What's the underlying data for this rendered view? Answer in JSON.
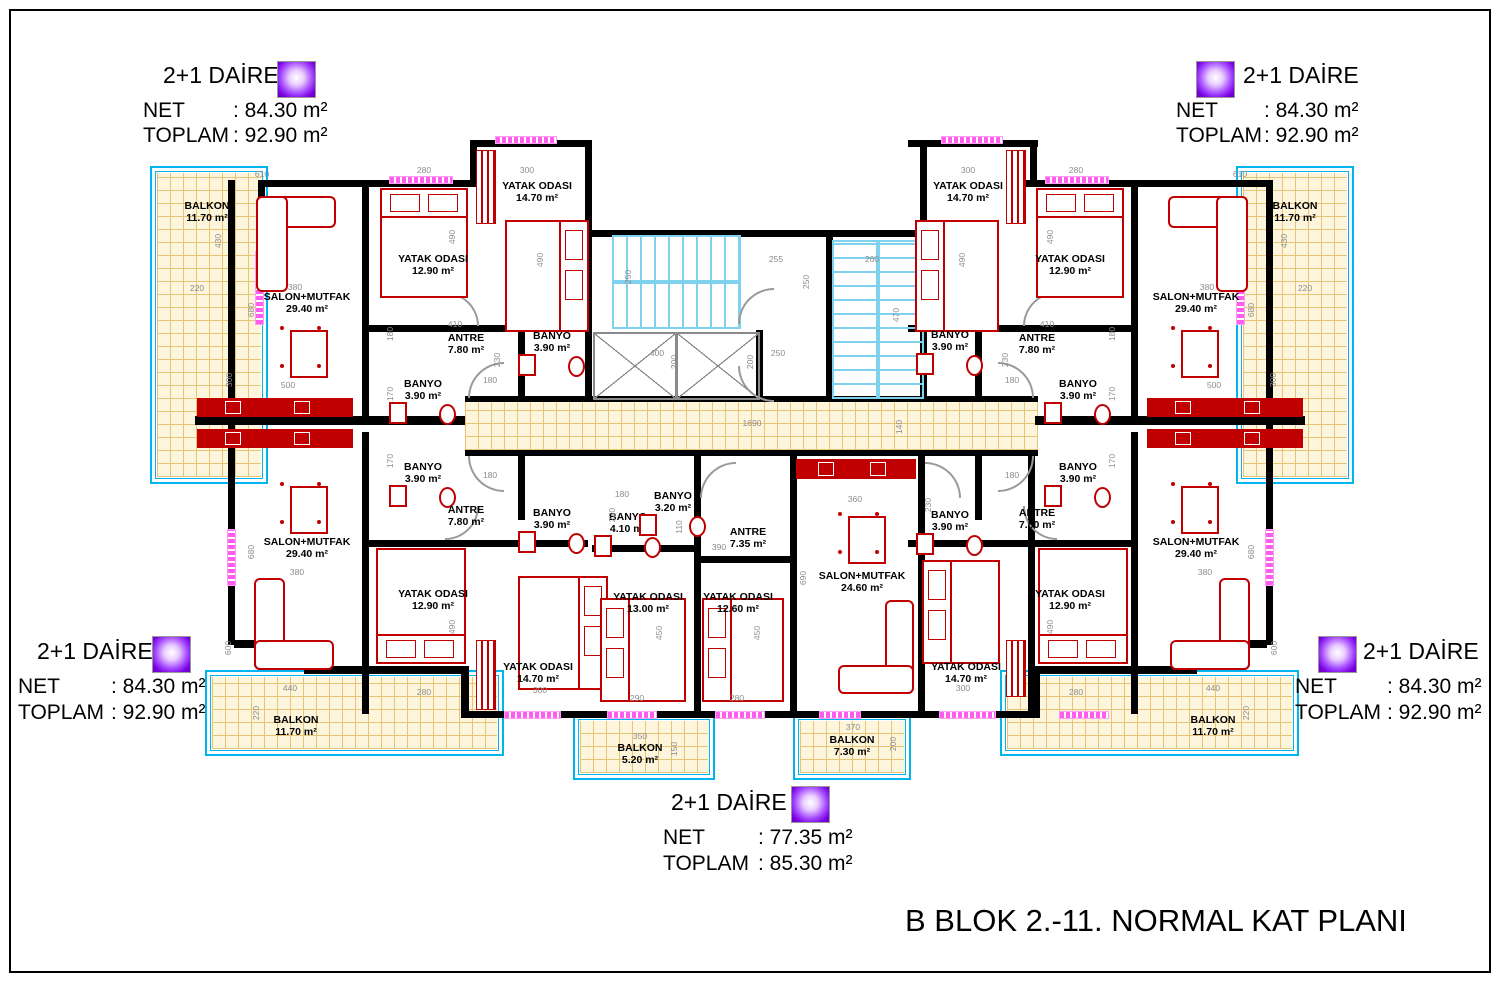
{
  "title": "B BLOK 2.-11. NORMAL KAT PLANI",
  "colors": {
    "wall": "#000000",
    "furniture": "#c00000",
    "stairs": "#7fd2ee",
    "balcony_border": "#00b4f0",
    "tile_line": "#e8c476",
    "tile_fill": "#fdf6dc",
    "dim_text": "#8c8c8c",
    "door": "#9a9a9a",
    "window": "#ff5cf0",
    "swatch_purple": "#7a00e0"
  },
  "apartments": [
    {
      "id": "top-left",
      "title": "2+1 DAİRE",
      "net_label": "NET",
      "net": ": 84.30 m²",
      "toplam_label": "TOPLAM",
      "toplam": ": 92.90 m²"
    },
    {
      "id": "top-right",
      "title": "2+1 DAİRE",
      "net_label": "NET",
      "net": ": 84.30 m²",
      "toplam_label": "TOPLAM",
      "toplam": ": 92.90 m²"
    },
    {
      "id": "bottom-left",
      "title": "2+1 DAİRE",
      "net_label": "NET",
      "net": ": 84.30 m²",
      "toplam_label": "TOPLAM",
      "toplam": ": 92.90 m²"
    },
    {
      "id": "bottom-right",
      "title": "2+1 DAİRE",
      "net_label": "NET",
      "net": ": 84.30 m²",
      "toplam_label": "TOPLAM",
      "toplam": ": 92.90 m²"
    },
    {
      "id": "bottom-center",
      "title": "2+1 DAİRE",
      "net_label": "NET",
      "net": ": 77.35 m²",
      "toplam_label": "TOPLAM",
      "toplam": ": 85.30 m²"
    }
  ],
  "plan": {
    "rooms": [
      {
        "name": "BALKON",
        "area": "11.70 m²",
        "x": 207,
        "y": 212
      },
      {
        "name": "SALON+MUTFAK",
        "area": "29.40 m²",
        "x": 307,
        "y": 303
      },
      {
        "name": "YATAK ODASI",
        "area": "12.90 m²",
        "x": 433,
        "y": 265
      },
      {
        "name": "YATAK ODASI",
        "area": "14.70 m²",
        "x": 537,
        "y": 192
      },
      {
        "name": "ANTRE",
        "area": "7.80 m²",
        "x": 466,
        "y": 344
      },
      {
        "name": "BANYO",
        "area": "3.90 m²",
        "x": 552,
        "y": 342
      },
      {
        "name": "BANYO",
        "area": "3.90 m²",
        "x": 423,
        "y": 390
      },
      {
        "name": "BANYO",
        "area": "3.90 m²",
        "x": 423,
        "y": 473
      },
      {
        "name": "YATAK ODASI",
        "area": "14.70 m²",
        "x": 968,
        "y": 192
      },
      {
        "name": "BANYO",
        "area": "3.90 m²",
        "x": 950,
        "y": 341
      },
      {
        "name": "ANTRE",
        "area": "7.80 m²",
        "x": 1037,
        "y": 344
      },
      {
        "name": "YATAK ODASI",
        "area": "12.90 m²",
        "x": 1070,
        "y": 265
      },
      {
        "name": "SALON+MUTFAK",
        "area": "29.40 m²",
        "x": 1196,
        "y": 303
      },
      {
        "name": "BALKON",
        "area": "11.70 m²",
        "x": 1295,
        "y": 212
      },
      {
        "name": "BANYO",
        "area": "3.90 m²",
        "x": 1078,
        "y": 390
      },
      {
        "name": "BANYO",
        "area": "3.90 m²",
        "x": 1078,
        "y": 473
      },
      {
        "name": "SALON+MUTFAK",
        "area": "29.40 m²",
        "x": 307,
        "y": 548
      },
      {
        "name": "ANTRE",
        "area": "7.80 m²",
        "x": 466,
        "y": 516
      },
      {
        "name": "BANYO",
        "area": "3.90 m²",
        "x": 552,
        "y": 519
      },
      {
        "name": "YATAK ODASI",
        "area": "12.90 m²",
        "x": 433,
        "y": 600
      },
      {
        "name": "YATAK ODASI",
        "area": "14.70 m²",
        "x": 538,
        "y": 673
      },
      {
        "name": "BALKON",
        "area": "11.70 m²",
        "x": 296,
        "y": 726
      },
      {
        "name": "BANYO",
        "area": "4.10 m²",
        "x": 628,
        "y": 523
      },
      {
        "name": "BANYO",
        "area": "3.20 m²",
        "x": 673,
        "y": 502
      },
      {
        "name": "ANTRE",
        "area": "7.35 m²",
        "x": 748,
        "y": 538
      },
      {
        "name": "YATAK ODASI",
        "area": "13.00 m²",
        "x": 648,
        "y": 603
      },
      {
        "name": "YATAK ODASI",
        "area": "12.60 m²",
        "x": 738,
        "y": 603
      },
      {
        "name": "SALON+MUTFAK",
        "area": "24.60 m²",
        "x": 862,
        "y": 582
      },
      {
        "name": "YATAK ODASI",
        "area": "14.70 m²",
        "x": 966,
        "y": 673
      },
      {
        "name": "BALKON",
        "area": "5.20 m²",
        "x": 640,
        "y": 754
      },
      {
        "name": "BALKON",
        "area": "7.30 m²",
        "x": 852,
        "y": 746
      },
      {
        "name": "BANYO",
        "area": "3.90 m²",
        "x": 950,
        "y": 521
      },
      {
        "name": "ANTRE",
        "area": "7.80 m²",
        "x": 1037,
        "y": 519
      },
      {
        "name": "YATAK ODASI",
        "area": "12.90 m²",
        "x": 1070,
        "y": 600
      },
      {
        "name": "SALON+MUTFAK",
        "area": "29.40 m²",
        "x": 1196,
        "y": 548
      },
      {
        "name": "BALKON",
        "area": "11.70 m²",
        "x": 1213,
        "y": 726
      }
    ],
    "dims": [
      {
        "t": "610",
        "x": 262,
        "y": 174
      },
      {
        "t": "280",
        "x": 424,
        "y": 170
      },
      {
        "t": "300",
        "x": 527,
        "y": 170
      },
      {
        "t": "300",
        "x": 968,
        "y": 170
      },
      {
        "t": "280",
        "x": 1076,
        "y": 170
      },
      {
        "t": "610",
        "x": 1240,
        "y": 174
      },
      {
        "t": "430",
        "x": 218,
        "y": 241,
        "r": 1
      },
      {
        "t": "430",
        "x": 1284,
        "y": 241,
        "r": 1
      },
      {
        "t": "220",
        "x": 197,
        "y": 288
      },
      {
        "t": "220",
        "x": 1305,
        "y": 288
      },
      {
        "t": "380",
        "x": 295,
        "y": 287
      },
      {
        "t": "380",
        "x": 1207,
        "y": 287
      },
      {
        "t": "680",
        "x": 251,
        "y": 310,
        "r": 1
      },
      {
        "t": "680",
        "x": 1251,
        "y": 310,
        "r": 1
      },
      {
        "t": "300",
        "x": 229,
        "y": 380,
        "r": 1
      },
      {
        "t": "300",
        "x": 1273,
        "y": 380,
        "r": 1
      },
      {
        "t": "500",
        "x": 288,
        "y": 385
      },
      {
        "t": "500",
        "x": 1214,
        "y": 385
      },
      {
        "t": "490",
        "x": 452,
        "y": 237,
        "r": 1
      },
      {
        "t": "490",
        "x": 1050,
        "y": 237,
        "r": 1
      },
      {
        "t": "490",
        "x": 540,
        "y": 260,
        "r": 1
      },
      {
        "t": "490",
        "x": 962,
        "y": 260,
        "r": 1
      },
      {
        "t": "410",
        "x": 455,
        "y": 324
      },
      {
        "t": "410",
        "x": 1047,
        "y": 324
      },
      {
        "t": "180",
        "x": 390,
        "y": 334,
        "r": 1
      },
      {
        "t": "180",
        "x": 1112,
        "y": 334,
        "r": 1
      },
      {
        "t": "170",
        "x": 390,
        "y": 394,
        "r": 1
      },
      {
        "t": "170",
        "x": 390,
        "y": 461,
        "r": 1
      },
      {
        "t": "170",
        "x": 1112,
        "y": 394,
        "r": 1
      },
      {
        "t": "170",
        "x": 1112,
        "y": 461,
        "r": 1
      },
      {
        "t": "230",
        "x": 497,
        "y": 360,
        "r": 1
      },
      {
        "t": "230",
        "x": 1005,
        "y": 360,
        "r": 1
      },
      {
        "t": "180",
        "x": 490,
        "y": 380
      },
      {
        "t": "180",
        "x": 1012,
        "y": 380
      },
      {
        "t": "180",
        "x": 490,
        "y": 475
      },
      {
        "t": "180",
        "x": 1012,
        "y": 475
      },
      {
        "t": "255",
        "x": 776,
        "y": 259
      },
      {
        "t": "250",
        "x": 806,
        "y": 282,
        "r": 1
      },
      {
        "t": "260",
        "x": 872,
        "y": 259
      },
      {
        "t": "250",
        "x": 628,
        "y": 277,
        "r": 1
      },
      {
        "t": "470",
        "x": 896,
        "y": 315,
        "r": 1
      },
      {
        "t": "400",
        "x": 657,
        "y": 353
      },
      {
        "t": "200",
        "x": 674,
        "y": 362,
        "r": 1
      },
      {
        "t": "250",
        "x": 778,
        "y": 353
      },
      {
        "t": "200",
        "x": 750,
        "y": 362,
        "r": 1
      },
      {
        "t": "1690",
        "x": 752,
        "y": 423
      },
      {
        "t": "140",
        "x": 899,
        "y": 427,
        "r": 1
      },
      {
        "t": "360",
        "x": 855,
        "y": 499
      },
      {
        "t": "180",
        "x": 622,
        "y": 494
      },
      {
        "t": "110",
        "x": 679,
        "y": 527,
        "r": 1
      },
      {
        "t": "390",
        "x": 719,
        "y": 547
      },
      {
        "t": "230",
        "x": 612,
        "y": 515,
        "r": 1
      },
      {
        "t": "230",
        "x": 928,
        "y": 505,
        "r": 1
      },
      {
        "t": "690",
        "x": 803,
        "y": 578,
        "r": 1
      },
      {
        "t": "680",
        "x": 251,
        "y": 552,
        "r": 1
      },
      {
        "t": "680",
        "x": 1251,
        "y": 552,
        "r": 1
      },
      {
        "t": "380",
        "x": 297,
        "y": 572
      },
      {
        "t": "380",
        "x": 1205,
        "y": 572
      },
      {
        "t": "450",
        "x": 659,
        "y": 633,
        "r": 1
      },
      {
        "t": "450",
        "x": 757,
        "y": 633,
        "r": 1
      },
      {
        "t": "490",
        "x": 452,
        "y": 627,
        "r": 1
      },
      {
        "t": "490",
        "x": 1050,
        "y": 627,
        "r": 1
      },
      {
        "t": "290",
        "x": 637,
        "y": 698
      },
      {
        "t": "280",
        "x": 737,
        "y": 698
      },
      {
        "t": "300",
        "x": 540,
        "y": 690
      },
      {
        "t": "300",
        "x": 963,
        "y": 688
      },
      {
        "t": "280",
        "x": 424,
        "y": 692
      },
      {
        "t": "280",
        "x": 1076,
        "y": 692
      },
      {
        "t": "600",
        "x": 228,
        "y": 648,
        "r": 1
      },
      {
        "t": "600",
        "x": 1274,
        "y": 648,
        "r": 1
      },
      {
        "t": "440",
        "x": 290,
        "y": 688
      },
      {
        "t": "440",
        "x": 1213,
        "y": 688
      },
      {
        "t": "220",
        "x": 256,
        "y": 713,
        "r": 1
      },
      {
        "t": "220",
        "x": 1246,
        "y": 713,
        "r": 1
      },
      {
        "t": "350",
        "x": 640,
        "y": 736
      },
      {
        "t": "150",
        "x": 674,
        "y": 749,
        "r": 1
      },
      {
        "t": "370",
        "x": 853,
        "y": 727
      },
      {
        "t": "200",
        "x": 893,
        "y": 744,
        "r": 1
      }
    ]
  }
}
